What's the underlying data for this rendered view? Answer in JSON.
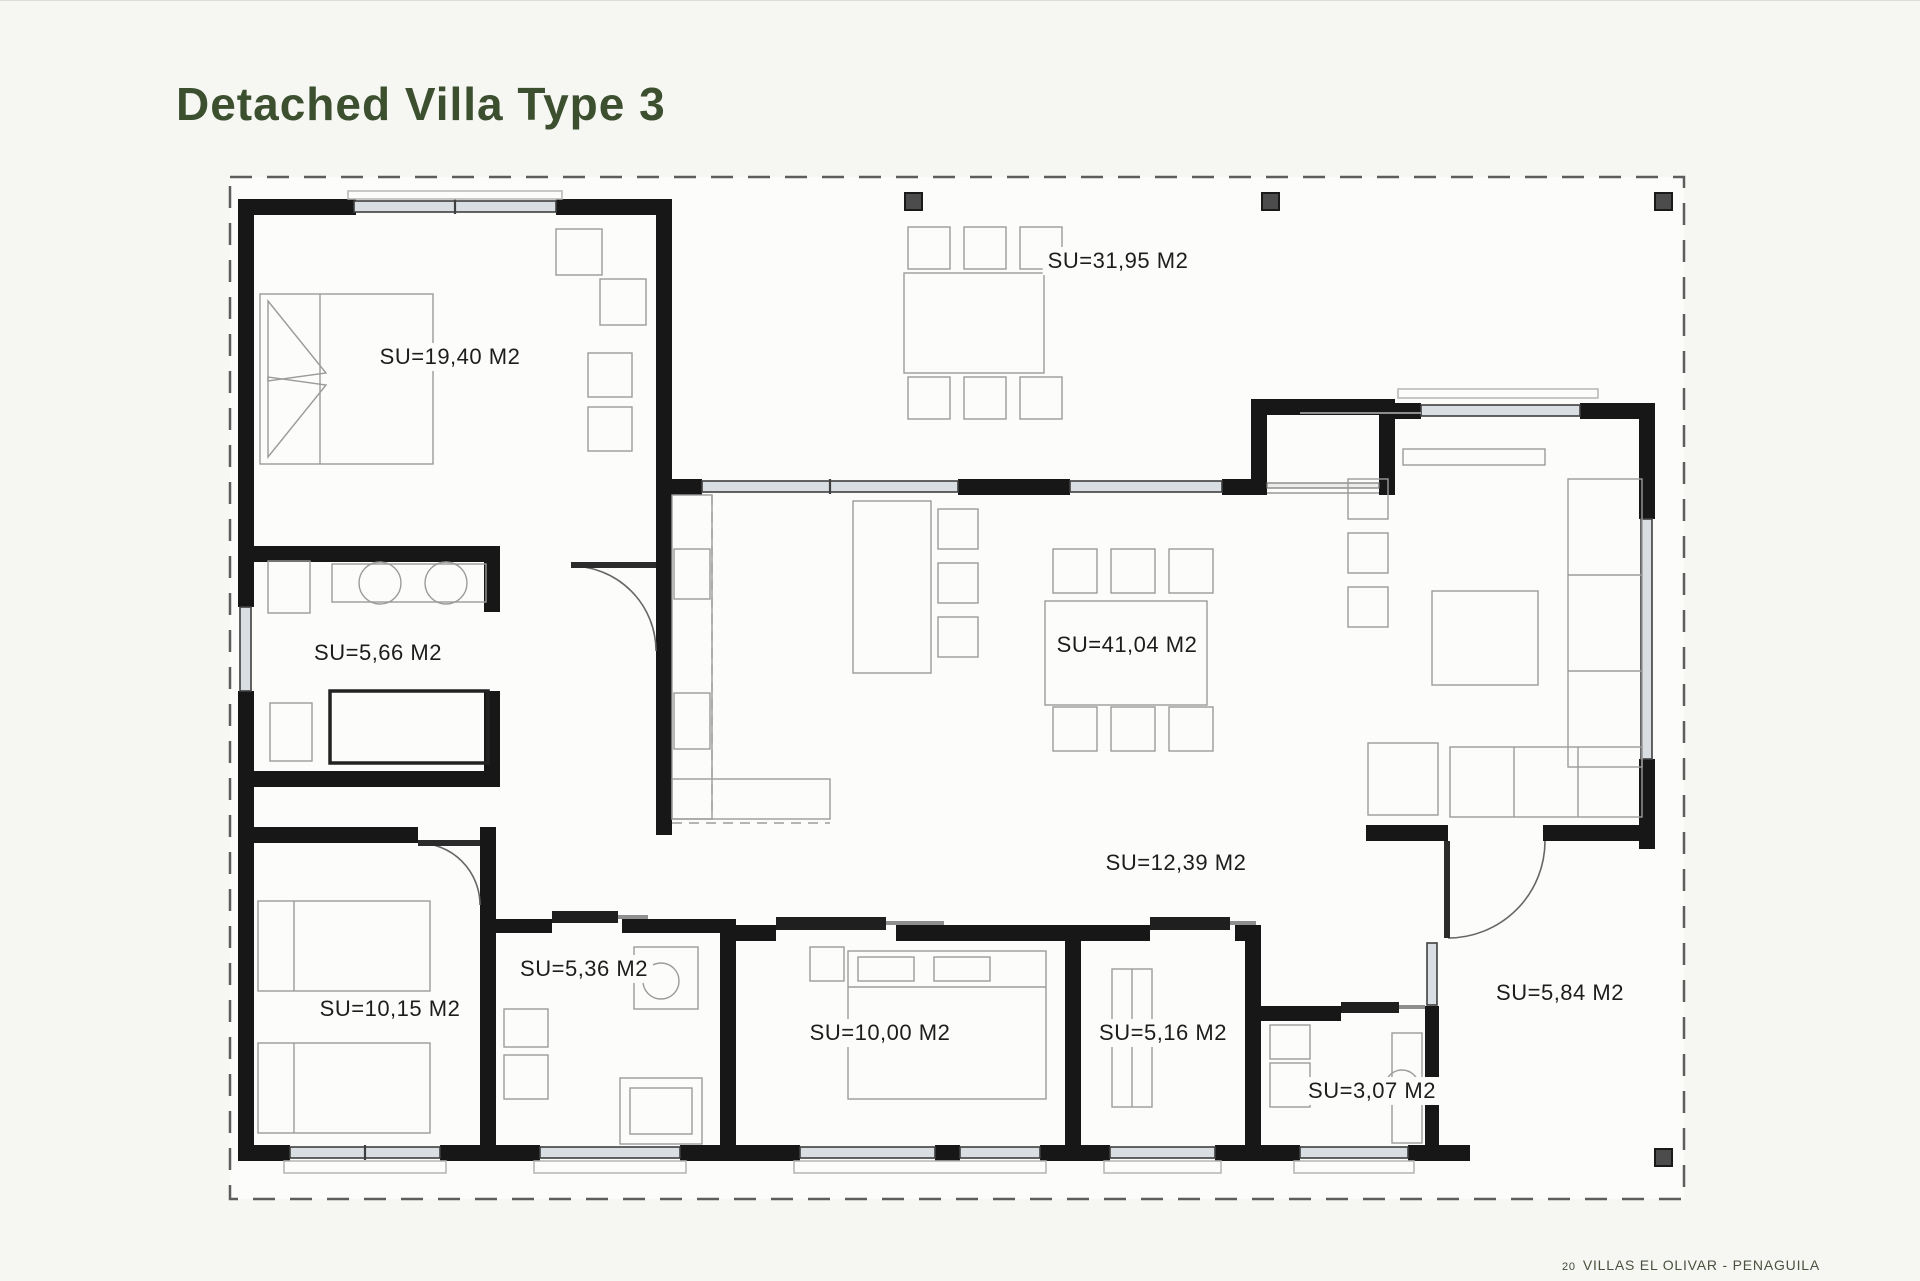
{
  "page": {
    "title": "Detached Villa Type 3",
    "footer": {
      "page_number": "20",
      "project_name": "VILLAS EL OLIVAR - PENAGUILA"
    }
  },
  "plan": {
    "area_prefix": "SU=",
    "area_unit": "M2",
    "rooms": [
      {
        "id": "main-bedroom",
        "label": "SU=19,40 M2",
        "area_m2": "19,40"
      },
      {
        "id": "terrace",
        "label": "SU=31,95 M2",
        "area_m2": "31,95"
      },
      {
        "id": "dressing-laundry",
        "label": "SU=5,66 M2",
        "area_m2": "5,66"
      },
      {
        "id": "kitchen-living-dining",
        "label": "SU=41,04 M2",
        "area_m2": "41,04"
      },
      {
        "id": "hallway",
        "label": "SU=12,39 M2",
        "area_m2": "12,39"
      },
      {
        "id": "bedroom-2",
        "label": "SU=10,15 M2",
        "area_m2": "10,15"
      },
      {
        "id": "bathroom-1",
        "label": "SU=5,36 M2",
        "area_m2": "5,36"
      },
      {
        "id": "bedroom-3",
        "label": "SU=10,00 M2",
        "area_m2": "10,00"
      },
      {
        "id": "bedroom-4",
        "label": "SU=5,16 M2",
        "area_m2": "5,16"
      },
      {
        "id": "bathroom-2",
        "label": "SU=3,07 M2",
        "area_m2": "3,07"
      },
      {
        "id": "porch",
        "label": "SU=5,84 M2",
        "area_m2": "5,84"
      }
    ]
  },
  "colors": {
    "title_green": "#3c4f2f",
    "wall": "#171717",
    "window_fill": "#d8dee2",
    "furniture_line": "#9b9b9b",
    "footer_text": "#49523f"
  }
}
